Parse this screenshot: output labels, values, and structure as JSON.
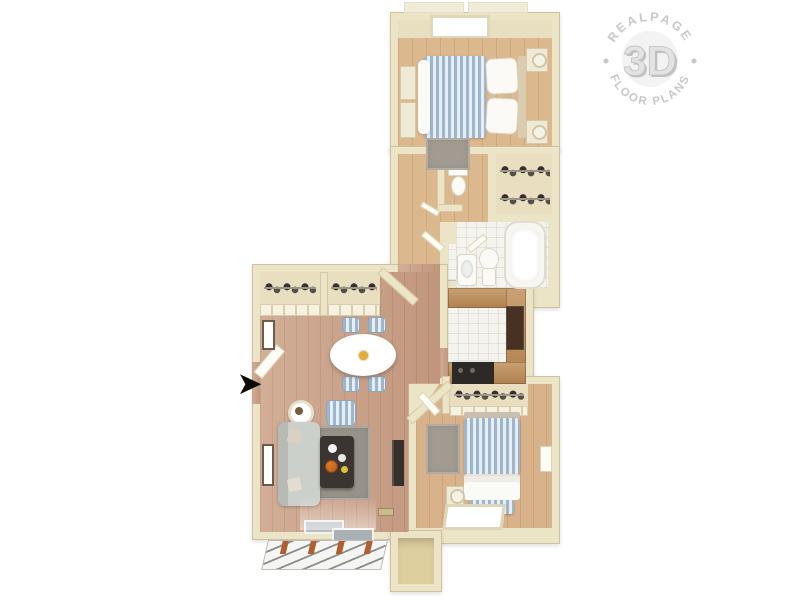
{
  "watermark": {
    "arc_top": "REALPAGE",
    "center": "3D",
    "arc_bottom": "FLOOR PLANS",
    "color": "#c8c8c8"
  },
  "entry": {
    "arrow_glyph": "➤",
    "arrow_color": "#0a0a0a"
  },
  "palette": {
    "background": "#ffffff",
    "wall": "#ece4c6",
    "wood_light": "#dcb88e",
    "wood_pink": "#cda58c",
    "tile_white": "#f4f3ee",
    "counter_wood": "#bd8c55",
    "closet_floor": "#e9dfc0",
    "bedding_blue": "#9db6cc",
    "rug_gray": "#a19b91",
    "deck_line": "#8d8d89",
    "post_orange": "#b06030",
    "appliance_dark": "#2c2926",
    "fridge_brown": "#463122"
  }
}
